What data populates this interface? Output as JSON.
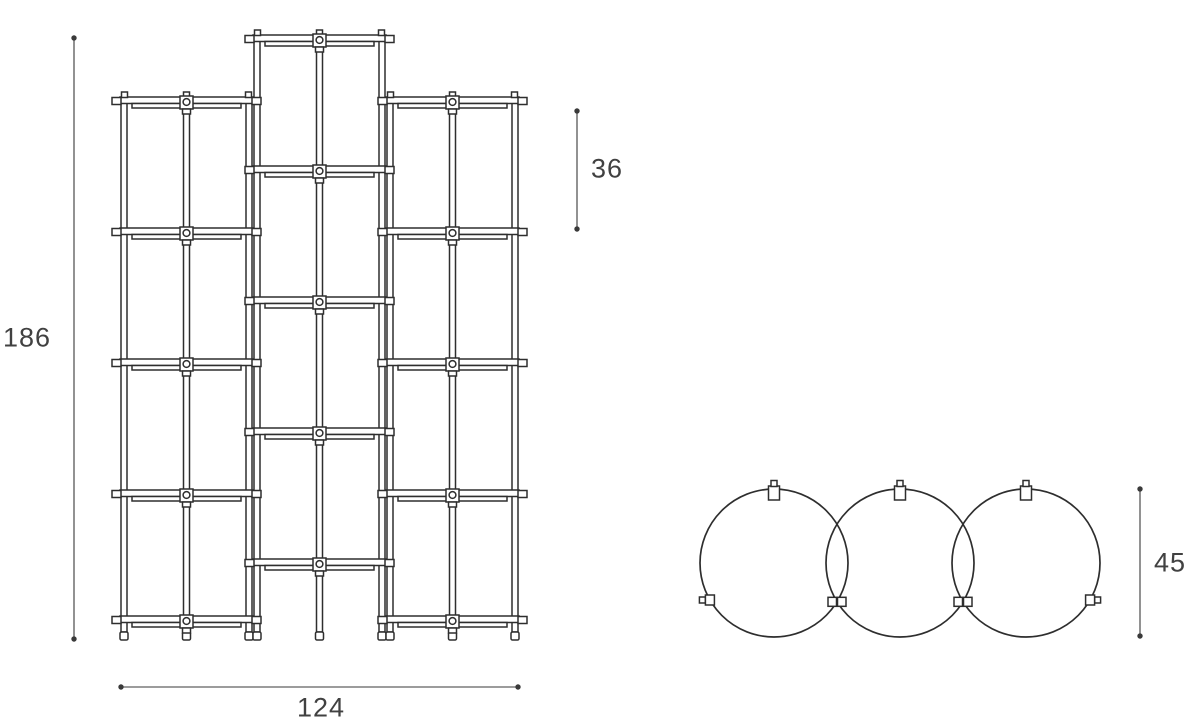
{
  "dimensions": {
    "overall_height": "186",
    "compartment_height": "36",
    "overall_width": "124",
    "shelf_diameter": "45"
  },
  "figure": {
    "type": "technical-dimension-drawing",
    "subject": "modular shelving unit",
    "views": [
      "front elevation with staggered middle column",
      "plan view of three overlapping round shelves"
    ],
    "front_view": {
      "floor_y": 640,
      "post_width": 6,
      "columns": [
        {
          "x_left": 121,
          "x_right": 252,
          "shelf_ys": [
            97,
            228,
            359,
            490,
            616
          ]
        },
        {
          "x_left": 254,
          "x_right": 385,
          "shelf_ys": [
            35,
            166,
            297,
            428,
            559
          ]
        },
        {
          "x_left": 387,
          "x_right": 518,
          "shelf_ys": [
            97,
            228,
            359,
            490,
            616
          ]
        }
      ],
      "dim_height": {
        "x": 74,
        "y1": 38,
        "y2": 639,
        "label_x": 27,
        "label_y": 338
      },
      "dim_cell": {
        "x": 577,
        "y1": 111,
        "y2": 229,
        "label_x": 607,
        "label_y": 169
      },
      "dim_width": {
        "y": 687,
        "x1": 121,
        "x2": 518,
        "label_x": 321,
        "label_y": 708
      }
    },
    "top_view": {
      "cy": 563,
      "r": 74,
      "circle_cx": [
        774,
        900,
        1026
      ],
      "dim_diameter": {
        "x": 1140,
        "y1": 489,
        "y2": 636,
        "label_x": 1170,
        "label_y": 563
      }
    },
    "style": {
      "line_color": "#2e2e2e",
      "dim_color": "#3a3a3a",
      "text_color": "#414141",
      "background": "#ffffff"
    }
  }
}
